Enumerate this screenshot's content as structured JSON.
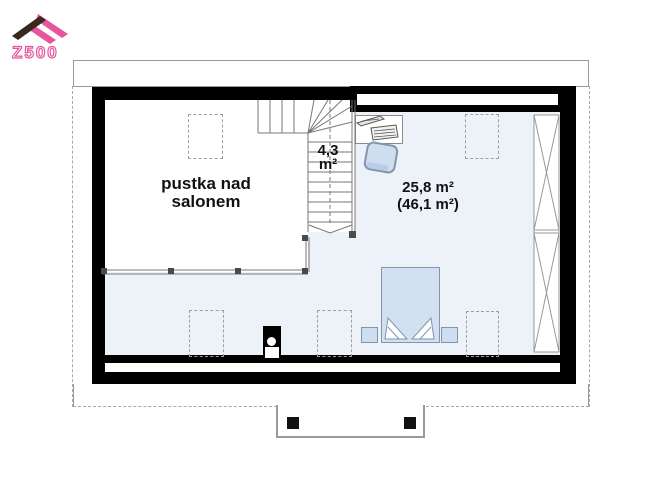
{
  "logo": {
    "text": "Z500"
  },
  "rooms": {
    "void": {
      "line1": "pustka nad",
      "line2": "salonem"
    },
    "stairs": {
      "line1": "4,3",
      "line2": "m²"
    },
    "bedroom": {
      "line1": "25,8 m²",
      "line2": "(46,1 m²)"
    }
  },
  "colors": {
    "logo_pink": "#e8559f",
    "logo_dark": "#362a1e",
    "wall": "#000000",
    "room_fill": "#edf1f8",
    "furniture_fill": "#cfdeef",
    "furniture_stroke": "#8096ad",
    "line_gray": "#777777"
  }
}
